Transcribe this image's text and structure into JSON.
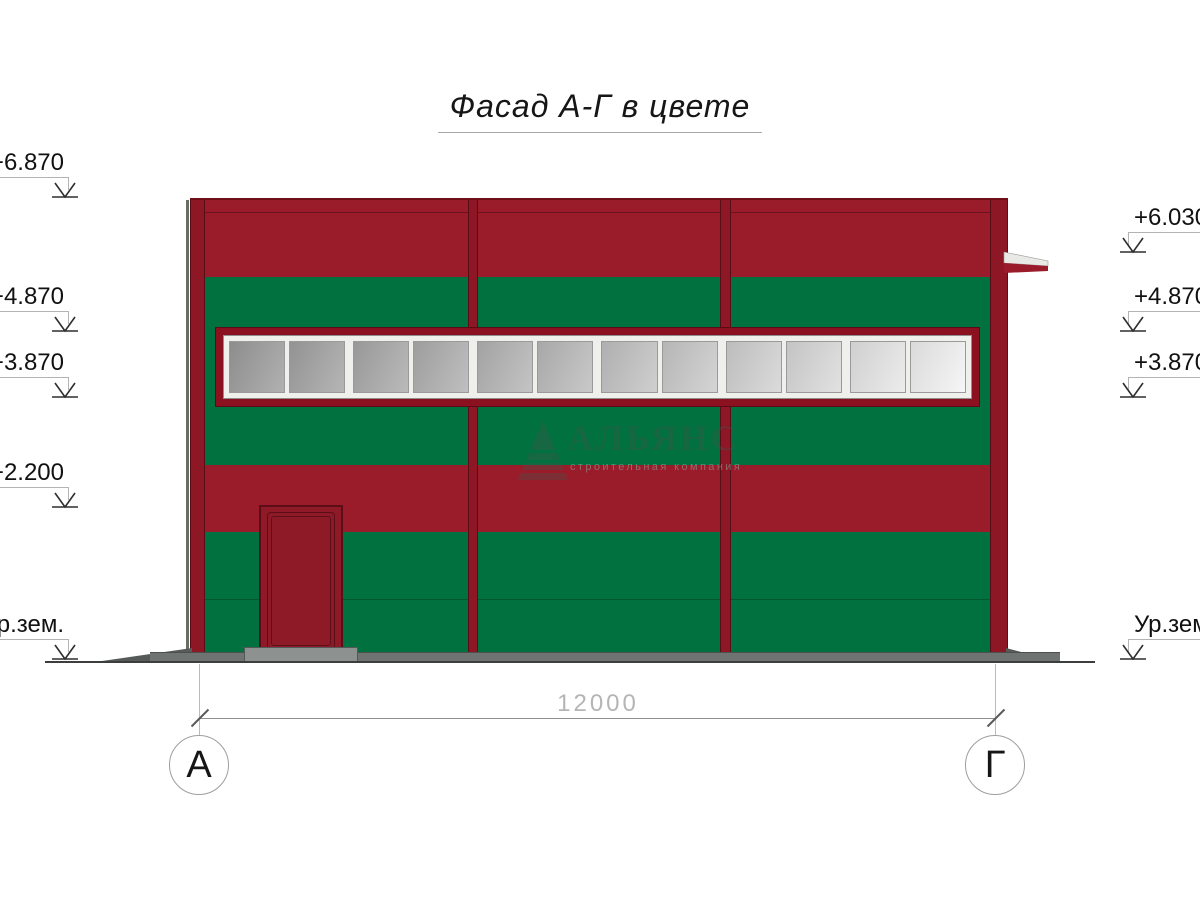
{
  "title": "Фасад А-Г в цвете",
  "watermark": {
    "company": "АЛЬЯНС",
    "tagline": "строительная компания"
  },
  "dimension": {
    "length_label": "12000"
  },
  "axis_markers": {
    "left": "А",
    "right": "Г"
  },
  "elevations": {
    "left": [
      {
        "label": "+6.870"
      },
      {
        "label": "+4.870"
      },
      {
        "label": "+3.870"
      },
      {
        "label": "+2.200"
      },
      {
        "label": "Ур.зем."
      }
    ],
    "right": [
      {
        "label": "+6.030"
      },
      {
        "label": "+4.870"
      },
      {
        "label": "+3.870"
      },
      {
        "label": "Ур.зем."
      }
    ]
  },
  "colors": {
    "facade_red": "#9a1b2a",
    "facade_green": "#00713f",
    "pilaster_red": "#8e1726",
    "window_frame_red": "#8c1120",
    "window_frame_white": "#efefec",
    "ground_gray": "#6f7473"
  },
  "window": {
    "pane_colors": [
      "#9d9d9d",
      "#a3a3a3",
      "#a9a9a9",
      "#afafaf",
      "#b5b5b5",
      "#bbbbbb",
      "#c3c3c3",
      "#cacaca",
      "#d2d2d2",
      "#dadada",
      "#e7e7e7",
      "#f3f3f3"
    ]
  }
}
